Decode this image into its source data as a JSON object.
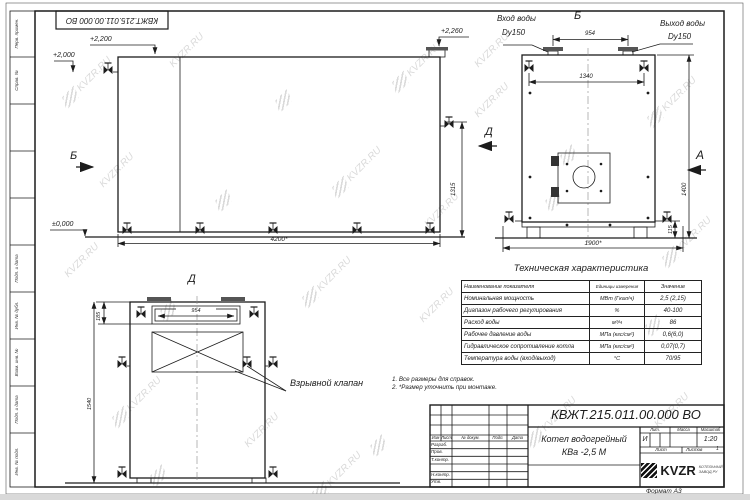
{
  "sheet": {
    "top_stamp": "КВЖТ.215.011.00.000 ВО",
    "format_label": "Формат А3",
    "watermark_text": "KVZR.RU",
    "margin_labels": [
      "Перв. примен.",
      "Справ. №",
      "",
      "",
      "",
      "Подп. и дата",
      "Инв. № дубл.",
      "Взам. инв. №",
      "Подп. и дата",
      "Инв. № подл."
    ]
  },
  "colors": {
    "line": "#1c1c1c",
    "watermark": "#c2c2c2"
  },
  "views": {
    "front": {
      "elev_2200": "+2,200",
      "elev_2000": "+2,000",
      "elev_2260": "+2,260",
      "elev_zero": "±0,000",
      "dim_length": "4200*",
      "dim_height": "1315",
      "label_b": "Б",
      "label_d": "Д"
    },
    "side": {
      "label_b": "Б",
      "label_a": "А",
      "inlet_line1": "Вход воды",
      "inlet_line2": "Dy150",
      "outlet_line1": "Выход воды",
      "outlet_line2": "Dy150",
      "dim_954": "954",
      "dim_1340": "1340",
      "dim_width": "1900*",
      "dim_height": "1400",
      "dim_115": "115"
    },
    "rear": {
      "title": "Д",
      "dim_954": "954",
      "dim_185": "185",
      "dim_1540": "1540",
      "explosion_valve_label": "Взрывной клапан"
    }
  },
  "notes": [
    "1. Все размеры для справок.",
    "2. *Размер уточнить при монтаже."
  ],
  "spec_table": {
    "title": "Техническая характеристика",
    "headers": [
      "Наименование показателя",
      "Единицы измерения",
      "Значение"
    ],
    "rows": [
      [
        "Номинальная мощность",
        "МВт (Гкал/ч)",
        "2,5 (2,15)"
      ],
      [
        "Диапазон рабочего регулирования",
        "%",
        "40-100"
      ],
      [
        "Расход воды",
        "м³/ч",
        "86"
      ],
      [
        "Рабочее давление воды",
        "МПа (кгс/см²)",
        "0,6(6,0)"
      ],
      [
        "Гидравлическое сопротивление котла",
        "МПа (кгс/см²)",
        "0,07(0,7)"
      ],
      [
        "Температура воды (вход/выход)",
        "°С",
        "70/95"
      ]
    ]
  },
  "title_block": {
    "doc_number": "КВЖТ.215.011.00.000 ВО",
    "product_name_line1": "Котел водогрейный",
    "product_name_line2": "КВа -2,5 М",
    "header_cols": [
      "Изм",
      "Лист",
      "№ докум.",
      "Подп.",
      "Дата"
    ],
    "row_labels": [
      "Разраб.",
      "Пров.",
      "Т.контр.",
      "",
      "Н.контр.",
      "Утв."
    ],
    "lit_label": "Лит.",
    "mass_label": "Масса",
    "scale_label": "Масштаб",
    "lit_value": "И",
    "scale_value": "1:20",
    "sheet_label": "Лист",
    "sheets_label": "Листов",
    "sheets_value": "1",
    "logo_text": "KVZR",
    "logo_sub1": "КОТЕЛЬНЫЙ",
    "logo_sub2": "ЗАВОД.РУ"
  }
}
